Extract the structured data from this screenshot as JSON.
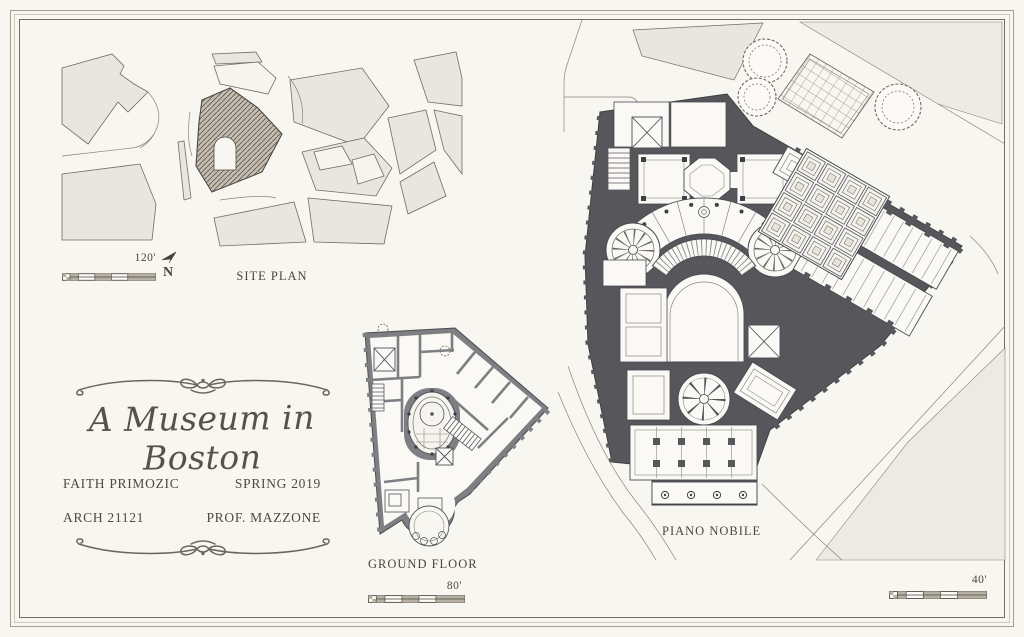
{
  "sheet": {
    "title": "A Museum in Boston",
    "student": "FAITH PRIMOZIC",
    "term": "SPRING 2019",
    "course": "ARCH 21121",
    "professor": "PROF. MAZZONE"
  },
  "drawings": {
    "site_plan": {
      "label": "SITE PLAN",
      "scale": "120'",
      "north": "N"
    },
    "ground_floor": {
      "label": "GROUND FLOOR",
      "scale": "80'"
    },
    "piano_nobile": {
      "label": "PIANO NOBILE",
      "scale": "40'"
    }
  },
  "colors": {
    "paper": "#f8f6f1",
    "ink": "#4a463f",
    "poche_dark": "#57565b",
    "poche_light": "#7f7e82",
    "block_fill": "#e9e6df",
    "hatch_fill": "#c4beb2"
  }
}
